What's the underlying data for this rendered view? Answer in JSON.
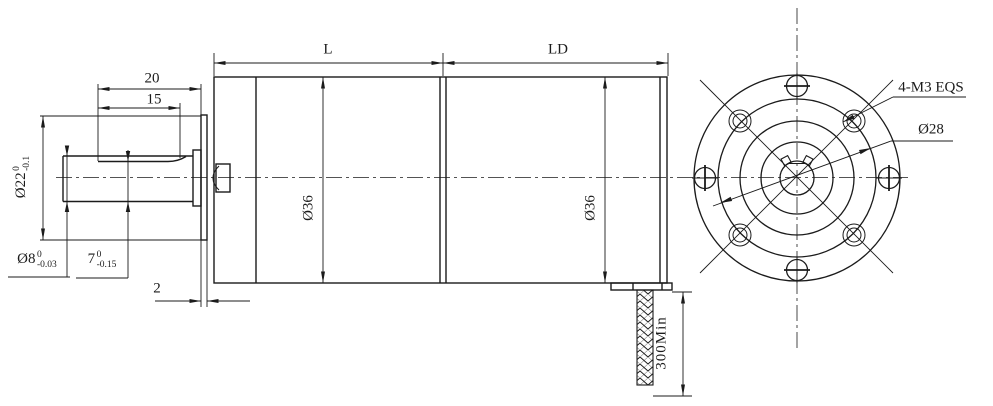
{
  "dims": {
    "len20": "20",
    "len15": "15",
    "thk2": "2",
    "d22": {
      "base": "Ø22",
      "sup": "0",
      "sub": "-0.1"
    },
    "d8": {
      "base": "Ø8",
      "sup": "0",
      "sub": "-0.03"
    },
    "d7": {
      "base": "7",
      "sup": "0",
      "sub": "-0.15"
    },
    "L": "L",
    "LD": "LD",
    "d36_gear": "Ø36",
    "d36_motor": "Ø36",
    "cable_min": "300Min"
  },
  "front": {
    "holes": "4-M3 EQS",
    "bolt_circle": "Ø28"
  },
  "colors": {
    "line": "#1b1b1b",
    "background": "#ffffff"
  }
}
